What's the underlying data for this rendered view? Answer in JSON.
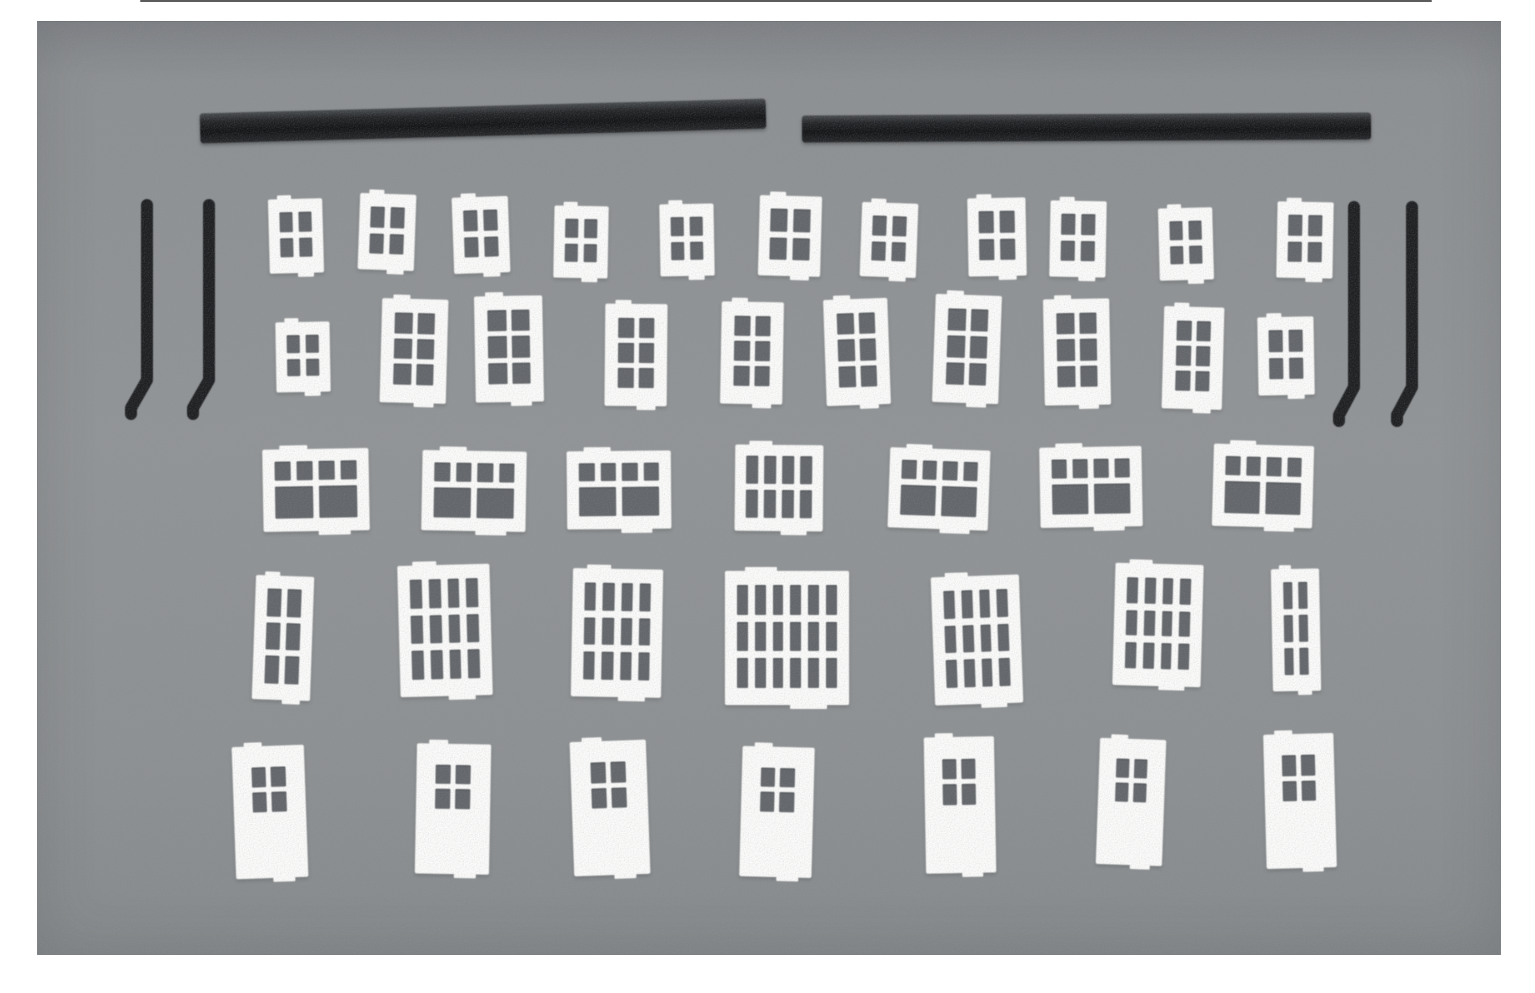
{
  "photo": {
    "page_background": "#ffffff",
    "mat_color": "#8e9192",
    "plastic_black": "#1d1f21",
    "part_white": "#fbfbfa",
    "pane_shadow": "#63666a",
    "photo_rect": {
      "x": 37,
      "y": 21,
      "w": 1464,
      "h": 934
    },
    "top_edge_line": {
      "x": 140,
      "y": 0,
      "w": 1292,
      "h": 2
    },
    "gutter_bars": [
      {
        "x": 200,
        "y": 106,
        "w": 566,
        "h": 30,
        "rot": -1.5
      },
      {
        "x": 802,
        "y": 114,
        "w": 569,
        "h": 27,
        "rot": -0.3
      }
    ],
    "downspouts": [
      {
        "x": 147,
        "y": 205,
        "drop": 175,
        "foot_dx": -16,
        "foot_dy": 28,
        "stub": 6
      },
      {
        "x": 209,
        "y": 205,
        "drop": 175,
        "foot_dx": -16,
        "foot_dy": 28,
        "stub": 6
      },
      {
        "x": 1354,
        "y": 207,
        "drop": 180,
        "foot_dx": -15,
        "foot_dy": 28,
        "stub": 6
      },
      {
        "x": 1412,
        "y": 207,
        "drop": 180,
        "foot_dx": -15,
        "foot_dy": 28,
        "stub": 6
      }
    ],
    "piece_types": {
      "small4": {
        "cols": 2,
        "rows": 2,
        "pad": [
          13,
          11,
          16,
          11
        ],
        "gap": 6
      },
      "tall6": {
        "cols": 2,
        "rows": 3,
        "pad": [
          14,
          13,
          18,
          13
        ],
        "gap": 5
      },
      "transom": {
        "cols": 4,
        "rows": 2,
        "pad": [
          12,
          12,
          13,
          12
        ],
        "gap": 6,
        "transom_frac": 0.34
      },
      "slat8": {
        "cols": 4,
        "rows": 2,
        "pad": [
          11,
          11,
          13,
          11
        ],
        "gap": 6
      },
      "grid2x3": {
        "cols": 2,
        "rows": 3,
        "pad": [
          13,
          12,
          16,
          12
        ],
        "gap": 6
      },
      "grid4x3": {
        "cols": 4,
        "rows": 3,
        "pad": [
          14,
          12,
          17,
          12
        ],
        "gap": 7
      },
      "grid6x3": {
        "cols": 6,
        "rows": 3,
        "pad": [
          14,
          12,
          17,
          12
        ],
        "gap": 7
      },
      "door": {
        "door": true,
        "win_cols": 2,
        "win_rows": 2,
        "win_top": 0.16,
        "win_left": 0.26,
        "win_w": 0.47,
        "win_h": 0.34,
        "win_gap": 5
      }
    },
    "pieces": [
      {
        "row": 1,
        "type": "small4",
        "x": 269,
        "y": 199,
        "w": 54,
        "h": 74,
        "rot": -1.5
      },
      {
        "row": 1,
        "type": "small4",
        "x": 359,
        "y": 194,
        "w": 56,
        "h": 76,
        "rot": 2
      },
      {
        "row": 1,
        "type": "small4",
        "x": 453,
        "y": 197,
        "w": 56,
        "h": 76,
        "rot": -2
      },
      {
        "row": 1,
        "type": "small4",
        "x": 554,
        "y": 206,
        "w": 54,
        "h": 72,
        "rot": 1
      },
      {
        "row": 1,
        "type": "small4",
        "x": 660,
        "y": 204,
        "w": 54,
        "h": 72,
        "rot": -1
      },
      {
        "row": 1,
        "type": "small4",
        "x": 759,
        "y": 196,
        "w": 62,
        "h": 80,
        "rot": 1.5
      },
      {
        "row": 1,
        "type": "small4",
        "x": 861,
        "y": 203,
        "w": 56,
        "h": 74,
        "rot": 2
      },
      {
        "row": 1,
        "type": "small4",
        "x": 968,
        "y": 198,
        "w": 58,
        "h": 78,
        "rot": -1
      },
      {
        "row": 1,
        "type": "small4",
        "x": 1050,
        "y": 201,
        "w": 56,
        "h": 76,
        "rot": 1
      },
      {
        "row": 1,
        "type": "small4",
        "x": 1159,
        "y": 208,
        "w": 54,
        "h": 72,
        "rot": -1.5
      },
      {
        "row": 1,
        "type": "small4",
        "x": 1277,
        "y": 202,
        "w": 56,
        "h": 76,
        "rot": 1
      },
      {
        "row": 2,
        "type": "small4",
        "x": 276,
        "y": 322,
        "w": 54,
        "h": 70,
        "rot": -1
      },
      {
        "row": 2,
        "type": "tall6",
        "x": 381,
        "y": 299,
        "w": 66,
        "h": 104,
        "rot": 1.5
      },
      {
        "row": 2,
        "type": "tall6",
        "x": 475,
        "y": 296,
        "w": 68,
        "h": 106,
        "rot": -1
      },
      {
        "row": 2,
        "type": "tall6",
        "x": 605,
        "y": 304,
        "w": 62,
        "h": 102,
        "rot": 0.5
      },
      {
        "row": 2,
        "type": "tall6",
        "x": 721,
        "y": 302,
        "w": 62,
        "h": 102,
        "rot": 1
      },
      {
        "row": 2,
        "type": "tall6",
        "x": 825,
        "y": 299,
        "w": 64,
        "h": 106,
        "rot": -2
      },
      {
        "row": 2,
        "type": "tall6",
        "x": 934,
        "y": 295,
        "w": 66,
        "h": 108,
        "rot": 2
      },
      {
        "row": 2,
        "type": "tall6",
        "x": 1044,
        "y": 299,
        "w": 66,
        "h": 106,
        "rot": -1
      },
      {
        "row": 2,
        "type": "tall6",
        "x": 1163,
        "y": 307,
        "w": 60,
        "h": 102,
        "rot": 1.5
      },
      {
        "row": 2,
        "type": "small4",
        "x": 1258,
        "y": 317,
        "w": 56,
        "h": 78,
        "rot": -1
      },
      {
        "row": 3,
        "type": "transom",
        "x": 263,
        "y": 449,
        "w": 106,
        "h": 82,
        "rot": -1
      },
      {
        "row": 3,
        "type": "transom",
        "x": 422,
        "y": 451,
        "w": 104,
        "h": 80,
        "rot": 1
      },
      {
        "row": 3,
        "type": "transom",
        "x": 567,
        "y": 451,
        "w": 104,
        "h": 78,
        "rot": -0.5
      },
      {
        "row": 3,
        "type": "slat8",
        "x": 735,
        "y": 445,
        "w": 88,
        "h": 86,
        "rot": 0.5
      },
      {
        "row": 3,
        "type": "transom",
        "x": 889,
        "y": 449,
        "w": 100,
        "h": 80,
        "rot": 2
      },
      {
        "row": 3,
        "type": "transom",
        "x": 1040,
        "y": 447,
        "w": 102,
        "h": 80,
        "rot": -1
      },
      {
        "row": 3,
        "type": "transom",
        "x": 1213,
        "y": 445,
        "w": 100,
        "h": 82,
        "rot": 1.5
      },
      {
        "row": 4,
        "type": "grid2x3",
        "x": 254,
        "y": 576,
        "w": 58,
        "h": 124,
        "rot": 2
      },
      {
        "row": 4,
        "type": "grid4x3",
        "x": 399,
        "y": 565,
        "w": 92,
        "h": 131,
        "rot": -1.5
      },
      {
        "row": 4,
        "type": "grid4x3",
        "x": 572,
        "y": 569,
        "w": 90,
        "h": 128,
        "rot": 1
      },
      {
        "row": 4,
        "type": "grid6x3",
        "x": 725,
        "y": 571,
        "w": 124,
        "h": 134,
        "rot": 0
      },
      {
        "row": 4,
        "type": "grid4x3",
        "x": 933,
        "y": 576,
        "w": 88,
        "h": 128,
        "rot": -2
      },
      {
        "row": 4,
        "type": "grid4x3",
        "x": 1114,
        "y": 564,
        "w": 88,
        "h": 122,
        "rot": 1.5
      },
      {
        "row": 4,
        "type": "grid2x3",
        "x": 1272,
        "y": 569,
        "w": 48,
        "h": 122,
        "rot": -1
      },
      {
        "row": 5,
        "type": "door",
        "x": 234,
        "y": 746,
        "w": 72,
        "h": 132,
        "rot": -2
      },
      {
        "row": 5,
        "type": "door",
        "x": 416,
        "y": 744,
        "w": 74,
        "h": 130,
        "rot": 1
      },
      {
        "row": 5,
        "type": "door",
        "x": 572,
        "y": 741,
        "w": 76,
        "h": 134,
        "rot": -2
      },
      {
        "row": 5,
        "type": "door",
        "x": 741,
        "y": 747,
        "w": 72,
        "h": 130,
        "rot": 1.5
      },
      {
        "row": 5,
        "type": "door",
        "x": 925,
        "y": 737,
        "w": 70,
        "h": 136,
        "rot": -1
      },
      {
        "row": 5,
        "type": "door",
        "x": 1098,
        "y": 739,
        "w": 66,
        "h": 126,
        "rot": 2
      },
      {
        "row": 5,
        "type": "door",
        "x": 1265,
        "y": 734,
        "w": 70,
        "h": 134,
        "rot": -1.5
      }
    ]
  }
}
